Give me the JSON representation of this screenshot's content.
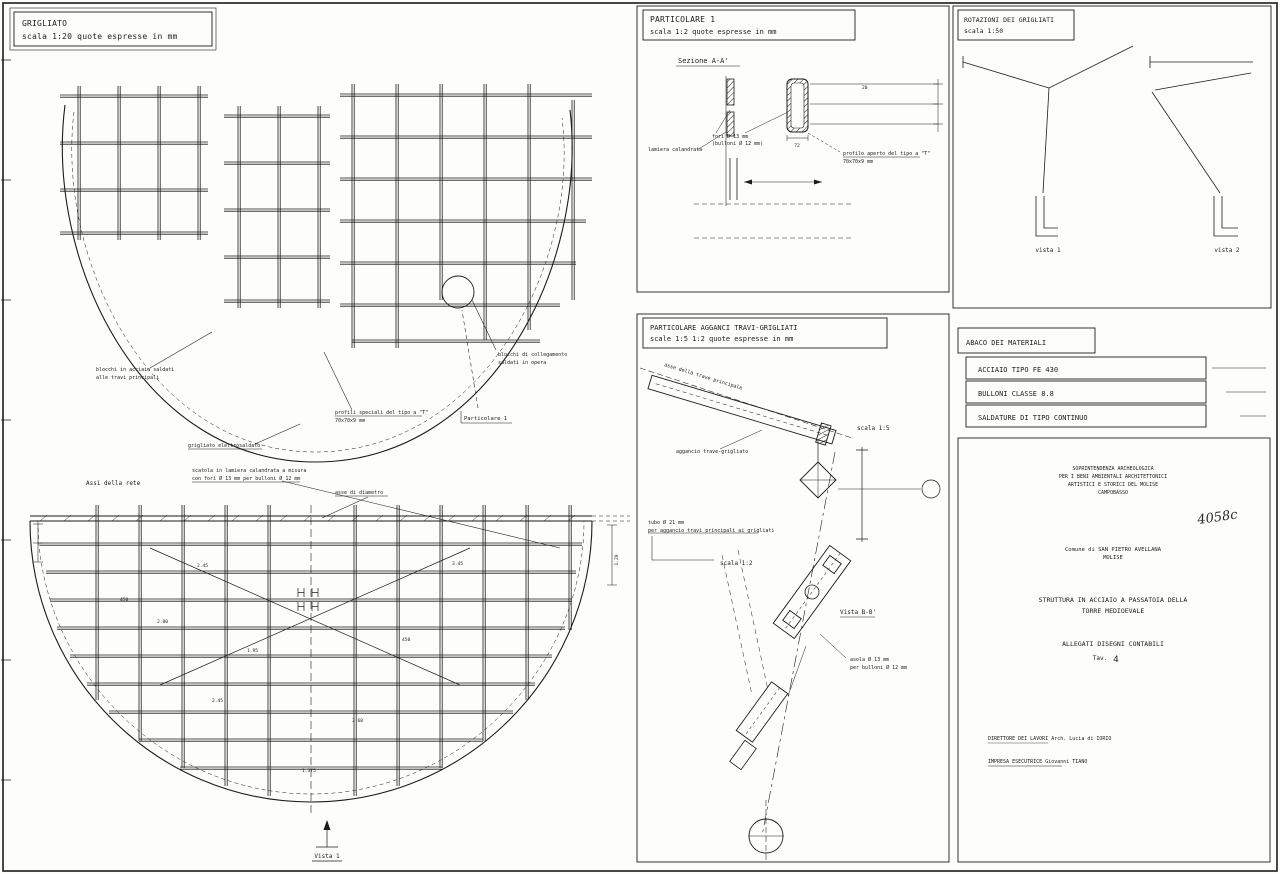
{
  "sheet": {
    "background": "#fdfdfc",
    "ink": "#1c1c1c"
  },
  "panels": {
    "grigliato": {
      "title": "GRIGLIATO",
      "subtitle": "scala 1:20 quote espresse in mm"
    },
    "particolare1": {
      "title": "PARTICOLARE 1",
      "subtitle": "scala 1:2 quote espresse in mm",
      "sezione_label": "Sezione A-A'",
      "label_lamiera": "lamiera calandrata",
      "label_fori_1": "fori Ø 13 mm",
      "label_fori_2": "(bulloni Ø 12 mm)",
      "label_profilo_1": "profilo aperto del tipo a \"T\"",
      "label_profilo_2": "70x70x9 mm",
      "dim_right": "20",
      "dim_under": "72"
    },
    "rotazioni": {
      "title": "ROTAZIONI DEI GRIGLIATI",
      "subtitle": "scala 1:50",
      "vista1": "vista 1",
      "vista2": "vista 2"
    },
    "agganci": {
      "title": "PARTICOLARE AGGANCI TRAVI-GRIGLIATI",
      "subtitle": "scale 1:5 1:2 quote espresse in mm",
      "scala15": "scala 1:5",
      "scala12": "scala 1:2",
      "label_asse": "asse della trave principale",
      "label_aggancio": "aggancio trave-grigliato",
      "label_tubo_1": "tubo Ø 21 mm",
      "label_tubo_2": "per aggancio travi principali ai grigliati",
      "vistabb": "Vista B-B'",
      "label_asola_1": "asola Ø 13 mm",
      "label_asola_2": "per bulloni Ø 12 mm"
    },
    "abaco": {
      "title": "ABACO DEI MATERIALI",
      "rows": [
        "ACCIAIO TIPO FE 430",
        "BULLONI CLASSE 8.8",
        "SALDATURE DI TIPO CONTINUO"
      ]
    },
    "titleblock": {
      "agency_lines": [
        "SOPRINTENDENZA ARCHEOLOGICA",
        "PER I BENI AMBIENTALI ARCHITETTONICI",
        "ARTISTICI E STORICI DEL MOLISE",
        "CAMPOBASSO"
      ],
      "stamp": "4058c",
      "comune_lines": [
        "Comune di SAN PIETRO AVELLANA",
        "MOLISE"
      ],
      "project_lines": [
        "STRUTTURA IN ACCIAIO A PASSATOIA DELLA",
        "TORRE MEDIOEVALE"
      ],
      "allegati": "ALLEGATI  DISEGNI  CONTABILI",
      "tav_label": "Tav.",
      "tav_number": "4",
      "direttore": "DIRETTORE DEI LAVORI   Arch. Lucia di IORIO",
      "impresa": "IMPRESA ESECUTRICE   Giovanni TIANO"
    }
  },
  "plan_top": {
    "label_blocchi_1": "blocchi in acciaio saldati",
    "label_blocchi_2": "alle travi principali",
    "label_grigliato": "grigliato elettrosaldato",
    "label_profili_1": "profili speciali del tipo a \"T\"",
    "label_profili_2": "70x70x9 mm",
    "label_particolare": "Particolare 1",
    "label_collegamento_1": "blocchi di collegamento",
    "label_collegamento_2": "saldati in opera"
  },
  "plan_bottom": {
    "label_assi": "Assi della rete",
    "label_scatola_1": "scatola in lamiera calandrata a misura",
    "label_scatola_2": "con fori Ø 13 mm per bulloni Ø 12 mm",
    "label_asse_diametro": "asse di diametro",
    "vista1": "Vista 1",
    "dims": [
      "2.45",
      "3.45",
      "450",
      "2.80",
      "1.95",
      "450",
      "2.45",
      "3.60",
      "1.375",
      "1.20"
    ]
  }
}
